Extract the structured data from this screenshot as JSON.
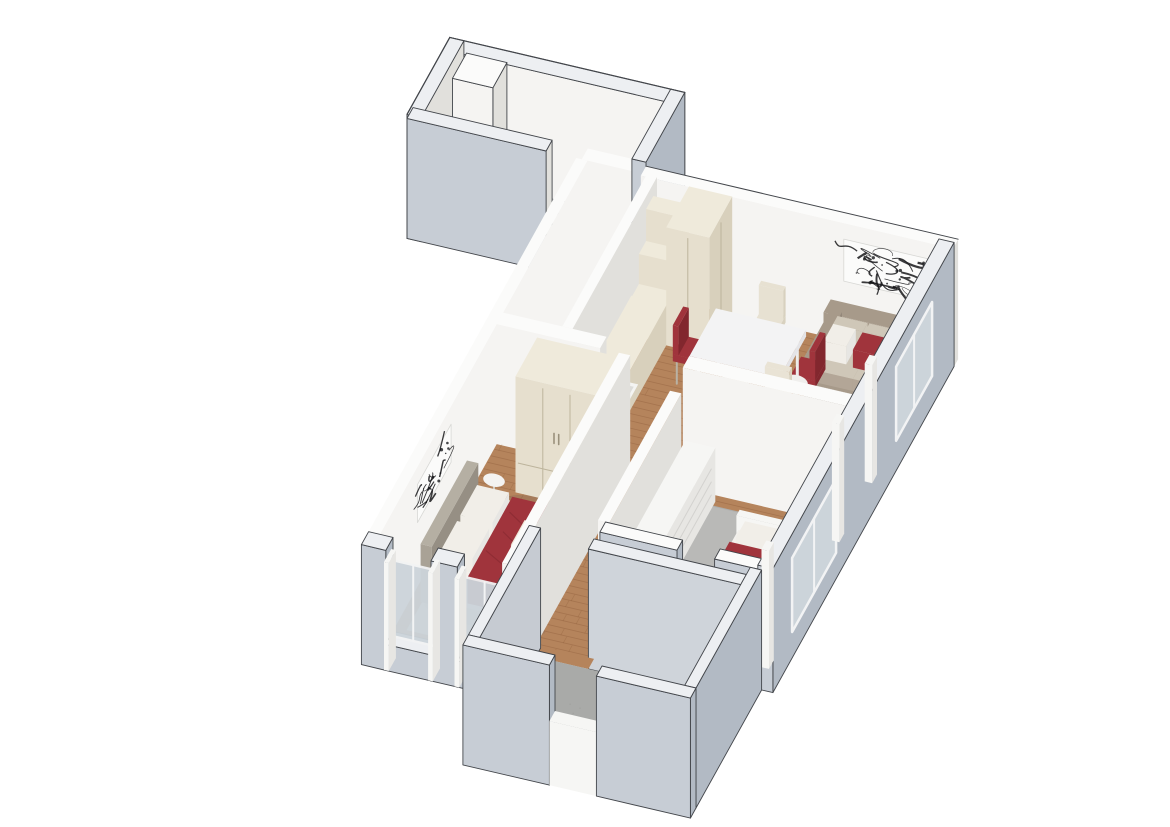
{
  "meta": {
    "description": "3D isometric cutaway render of a two-bedroom apartment floor plan on a white background",
    "view": "axonometric bird's-eye cutaway",
    "background": "#ffffff"
  },
  "palette": {
    "background": "#ffffff",
    "outline": "#43464b",
    "ext_wall_side": "#c7cdd5",
    "ext_wall_side_dark": "#b2bac4",
    "ext_wall_top": "#edeff2",
    "int_wall_lit": "#f5f4f2",
    "int_wall_shade": "#e1e0dc",
    "int_wall_top": "#fbfbfa",
    "wood": "#b5845c",
    "wood_line": "rgba(110,60,30,0.22)",
    "pale_floor": "#e9e5dc",
    "hall_floor": "#ecebe8",
    "marble": "#eceded",
    "marble_vein": "#8b9199",
    "carpet": "#b9b9b7",
    "stone": "#a9aaa8",
    "stone_light": "#c0c1bf",
    "rug_cream": "#e9e4d6",
    "rug_living": "#dcd5c6",
    "cabinet": "#e6dfce",
    "cabinet_side": "#d8d0bc",
    "cabinet_top": "#efeadb",
    "cabinet_line": "#bdb49c",
    "white_top": "#f6f6f4",
    "white_side": "#e7e6e3",
    "sofa": "#a79a8a",
    "sofa_dark": "#93877a",
    "sofa_cushion": "#cfc7b8",
    "sofa_seat": "#b3a697",
    "pillow_white": "#f1eee8",
    "red": "#a0343c",
    "red_dark": "#82272e",
    "headboard": "#a9a296",
    "headboard_dark": "#968f84",
    "glass": "#ccd4da",
    "art_bg": "#fbfbfa",
    "art_ink": "#17181a",
    "shadow": "rgba(70,70,80,0.14)"
  },
  "scene": {
    "rooms": [
      {
        "id": "bathroom-1",
        "label": "Bathroom",
        "floor": "white marble"
      },
      {
        "id": "entry-hall",
        "label": "Entry hall",
        "floor": "pale"
      },
      {
        "id": "kitchen",
        "label": "Kitchen",
        "floor": "wood parquet"
      },
      {
        "id": "dining-area",
        "label": "Dining area",
        "floor": "wood parquet"
      },
      {
        "id": "living-area",
        "label": "Living area",
        "floor": "pale beige"
      },
      {
        "id": "corridor",
        "label": "Corridor",
        "floor": "wood parquet"
      },
      {
        "id": "master-bedroom",
        "label": "Master bedroom",
        "floor": "wood with cream rug"
      },
      {
        "id": "bedroom-2",
        "label": "Second bedroom",
        "floor": "gray carpet"
      },
      {
        "id": "bathroom-2",
        "label": "Second bathroom / loggia",
        "floor": "gray stone with step"
      }
    ],
    "furniture": [
      {
        "room": "bathroom-1",
        "items": [
          "walk-in shower ledge",
          "service column"
        ]
      },
      {
        "room": "kitchen",
        "items": [
          "cream cabinet run",
          "counter with sink",
          "tall cream cabinet",
          "open shelves"
        ]
      },
      {
        "room": "dining-area",
        "items": [
          "white marble dining table",
          "two red dining chairs",
          "two cream dining chairs"
        ]
      },
      {
        "room": "living-area",
        "items": [
          "taupe three-seat sofa",
          "white and red throw pillows",
          "abstract black-and-white wall art",
          "marble coffee table",
          "round marble side table",
          "cream armchair",
          "beige area rug"
        ]
      },
      {
        "room": "master-bedroom",
        "items": [
          "double bed with white linen",
          "burgundy throw blanket",
          "cream deco pillow",
          "taupe upholstered headboard",
          "cream three-door wardrobe",
          "round white bedside table",
          "abstract wall art",
          "cream area rug"
        ]
      },
      {
        "room": "bedroom-2",
        "items": [
          "single bed with burgundy cover",
          "white drawer dresser"
        ]
      },
      {
        "room": "bathroom-2",
        "items": [
          "stone floor",
          "step ledge"
        ]
      },
      {
        "room": "shell",
        "items": [
          "cutaway exterior walls",
          "window openings with glass",
          "door notches"
        ]
      }
    ]
  }
}
